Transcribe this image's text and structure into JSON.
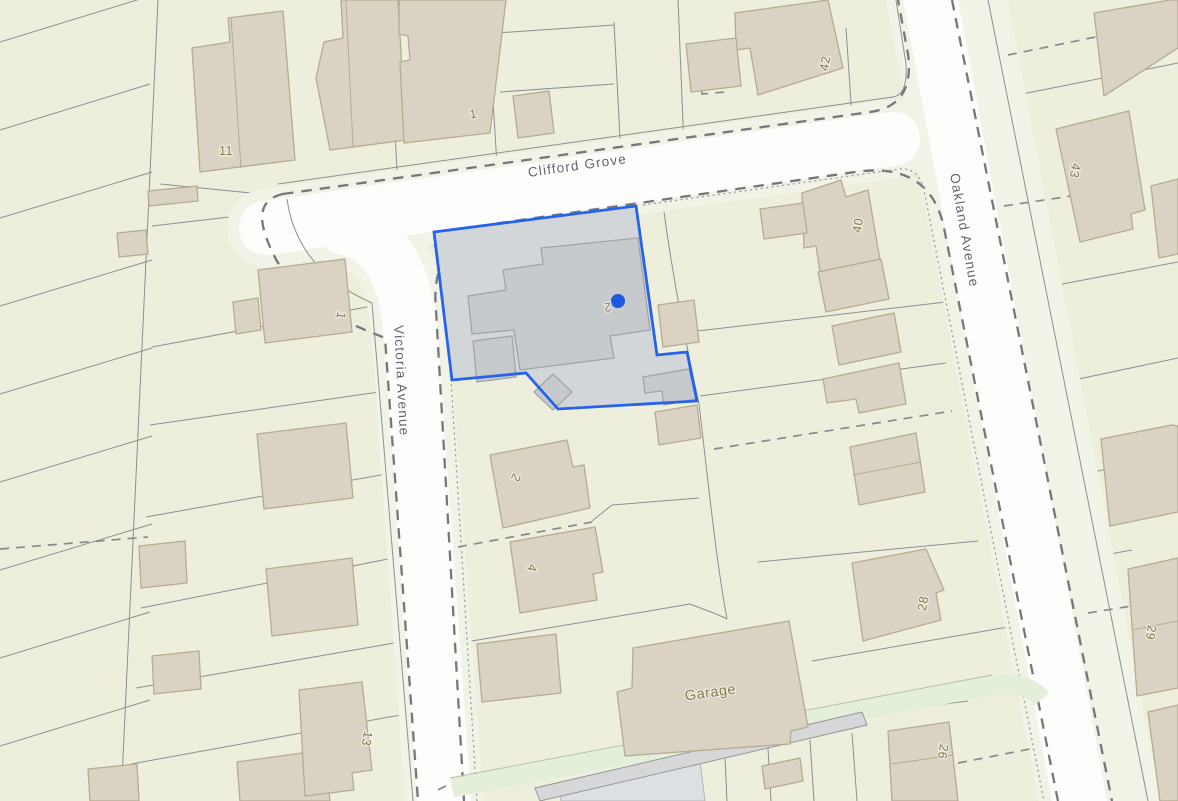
{
  "map": {
    "streets": {
      "clifford_grove": "Clifford Grove",
      "oakland_avenue": "Oakland Avenue",
      "victoria_avenue": "Victoria Avenue"
    },
    "plots": {
      "p11": "11",
      "p1_north": "1",
      "p42": "42",
      "p40": "40",
      "p43": "43",
      "p1_west": "1",
      "p2_selected": "2",
      "p2_south": "2",
      "p4": "4",
      "p28": "28",
      "p29": "29",
      "p26": "26",
      "p13": "13",
      "garage": "Garage"
    },
    "selection": {
      "selected_plot_label": "2",
      "outline_color": "#2563eb",
      "marker_color": "#1f58e0"
    },
    "colors": {
      "parcel_fill": "#edefdc",
      "sidewalk_fill": "#f2f3e7",
      "road_fill": "#fdfdfc",
      "building_fill": "#dad3c3",
      "building_outline": "#b5ab8f",
      "boundary_line": "#8b9094",
      "selected_parcel_fill": "#d3d6d8",
      "selected_building_fill": "#c7cacc",
      "plot_label": "#867c48",
      "street_label": "#5f666d",
      "green_verge": "#e4efda",
      "footpath_gray": "#d5d7d9"
    }
  }
}
